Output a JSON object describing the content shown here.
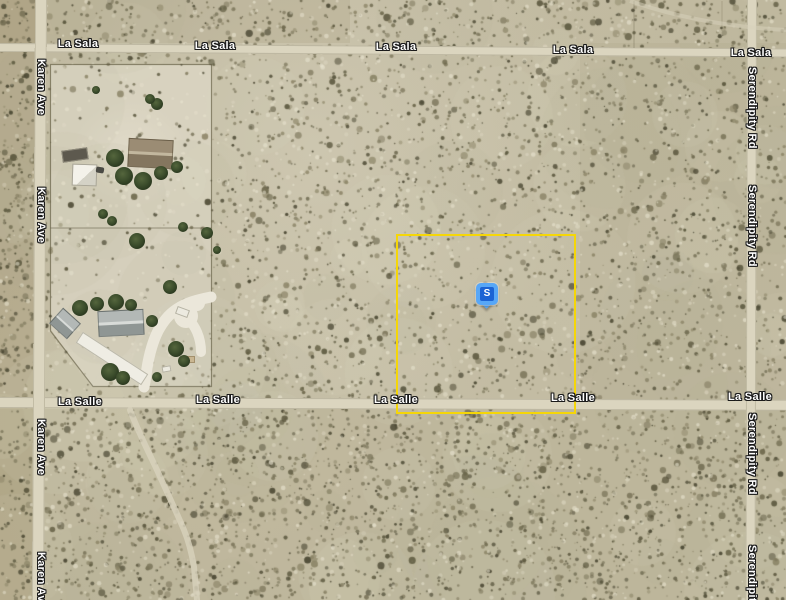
{
  "road_labels": {
    "la_sala": "La Sala",
    "la_salle": "La Salle",
    "karen_ave": "Karen Ave",
    "serendipity_rd": "Serendipity Rd"
  },
  "marker": {
    "letter": "S"
  },
  "colors": {
    "parcel_outline": "#F5D608",
    "marker_pin": "#57A7F7",
    "marker_badge": "#1B63D4",
    "marker_letter": "#FFFFFF",
    "road_label_text": "#FFFFFF",
    "road_label_outline": "#1A1A1A"
  }
}
